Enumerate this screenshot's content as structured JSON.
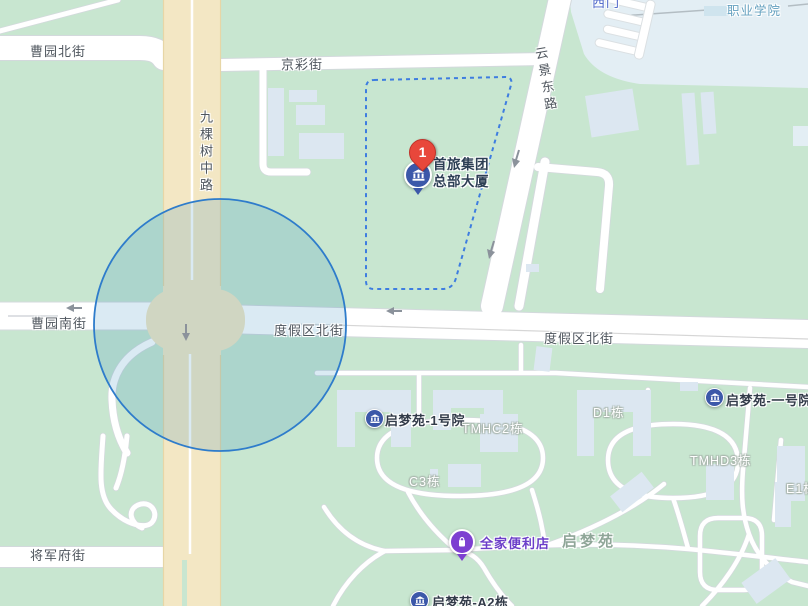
{
  "map": {
    "streets": {
      "caoyuan_north": "曹园北街",
      "jingcai": "京彩街",
      "jiukeshu_middle": "九棵树中路",
      "yunjing_east": "云景东路",
      "caoyuan_south": "曹园南街",
      "dujiaqu_north": "度假区北街",
      "jiangjunfu": "将军府街"
    },
    "areas": {
      "campus": "职业学院",
      "west_gate": "西门",
      "residential": "启梦苑"
    },
    "building_labels": {
      "qimengyuan_yard1": "启梦苑-1号院",
      "tmhc2": "TMHC2栋",
      "d1": "D1栋",
      "qimengyuan_no1": "启梦苑-一号院",
      "c3": "C3栋",
      "tmhd3": "TMHD3栋",
      "e1": "E1栋",
      "qimengyuan_a2": "启梦苑-A2栋"
    },
    "markers": {
      "main_poi": {
        "badge": "1",
        "label_line1": "首旅集团",
        "label_line2": "总部大厦",
        "icon": "building-icon"
      },
      "store": {
        "label": "全家便利店",
        "icon": "shopping-bag-icon"
      },
      "residential_pois": {
        "icon": "building-icon"
      }
    },
    "colors": {
      "land": "#c8e6d0",
      "road_main": "#f3e7c4",
      "road_white": "#ffffff",
      "building": "#dce7f1",
      "campus_fill": "#e3eef4",
      "selection_stroke": "#3e7de0",
      "circle_stroke": "#2e7ccb",
      "pin_red": "#e8473b",
      "poi_blue": "#3c58a9",
      "store_purple": "#7d3fd1",
      "street_text": "#4f565e",
      "area_text": "#8fa698",
      "campus_text": "#64a0bf",
      "gate_text": "#4a63c8",
      "store_text": "#6b3ec9",
      "poi_text": "#2c3e54"
    }
  }
}
